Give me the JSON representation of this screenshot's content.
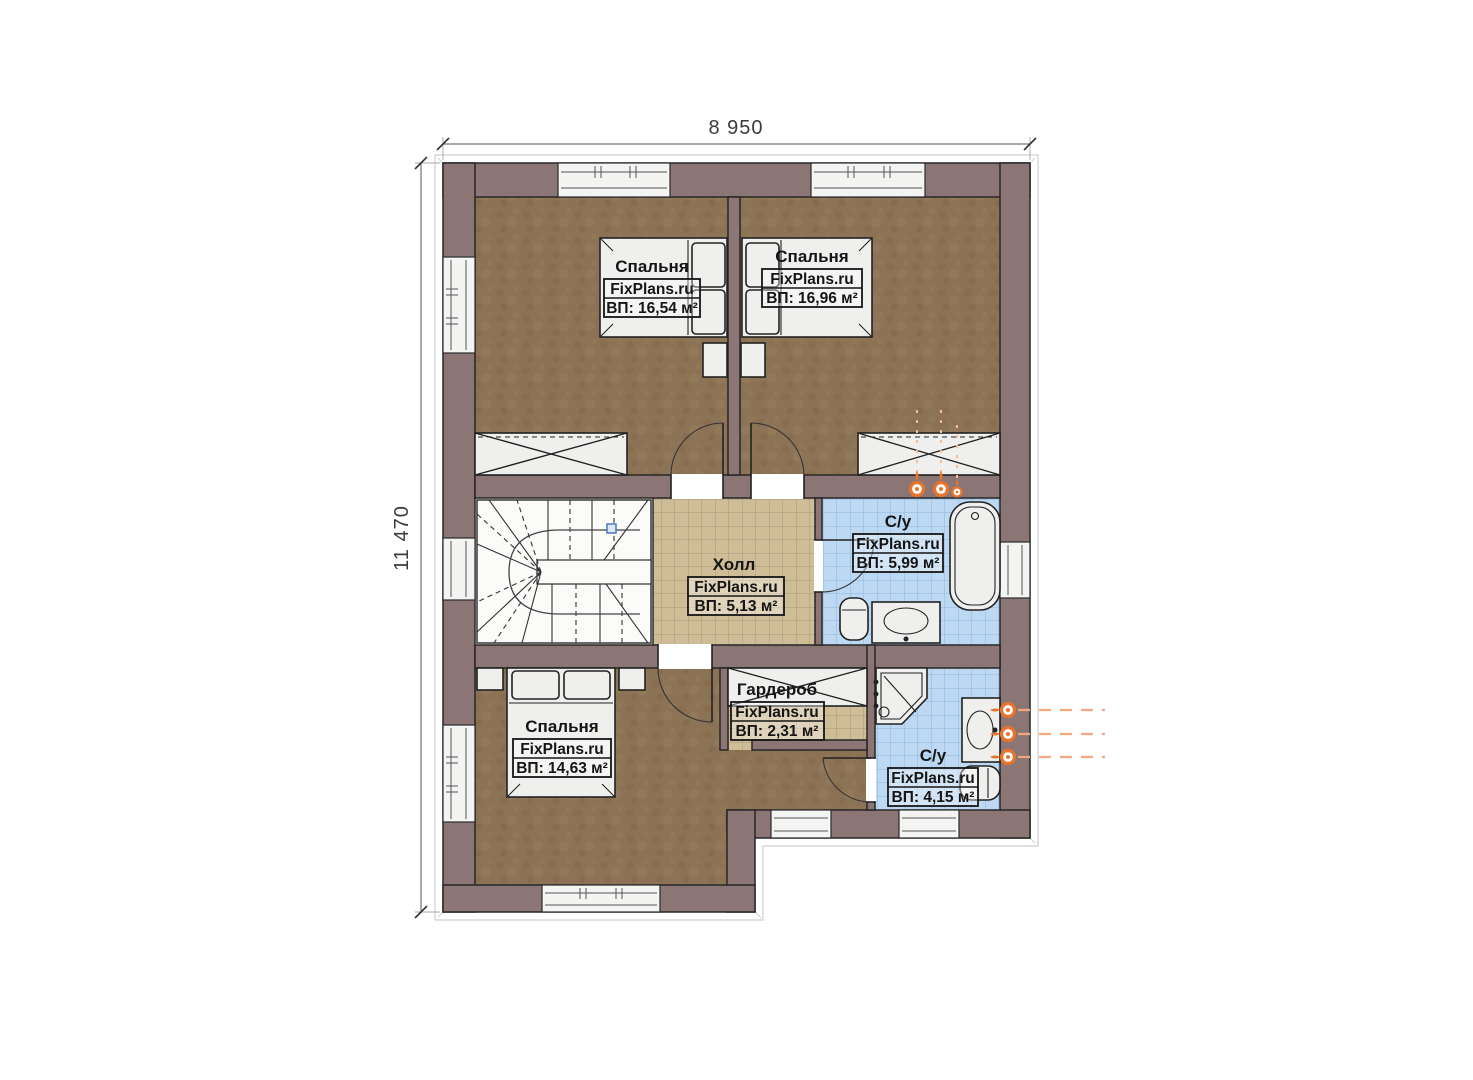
{
  "dimensions": {
    "width": "8 950",
    "height": "11 470"
  },
  "brand": "FixPlans.ru",
  "rooms": {
    "bedroom1": {
      "name": "Спальня",
      "brand": "FixPlans.ru",
      "area": "ВП: 16,54 м²"
    },
    "bedroom2": {
      "name": "Спальня",
      "brand": "FixPlans.ru",
      "area": "ВП: 16,96 м²"
    },
    "hall": {
      "name": "Холл",
      "brand": "FixPlans.ru",
      "area": "ВП: 5,13 м²"
    },
    "bath1": {
      "name": "С/у",
      "brand": "FixPlans.ru",
      "area": "ВП: 5,99 м²"
    },
    "bedroom3": {
      "name": "Спальня",
      "brand": "FixPlans.ru",
      "area": "ВП: 14,63 м²"
    },
    "wardrobe": {
      "name": "Гардероб",
      "brand": "FixPlans.ru",
      "area": "ВП: 2,31 м²"
    },
    "bath2": {
      "name": "С/у",
      "brand": "FixPlans.ru",
      "area": "ВП: 4,15 м²"
    }
  },
  "colors": {
    "wall": "#8c7575",
    "bedroom_floor": "#8d7355",
    "hall_floor": "#cfbd98",
    "bath_floor": "#bdd8f2",
    "stair_floor": "#f7f7f5",
    "radiator_accent": "#e8742c"
  }
}
